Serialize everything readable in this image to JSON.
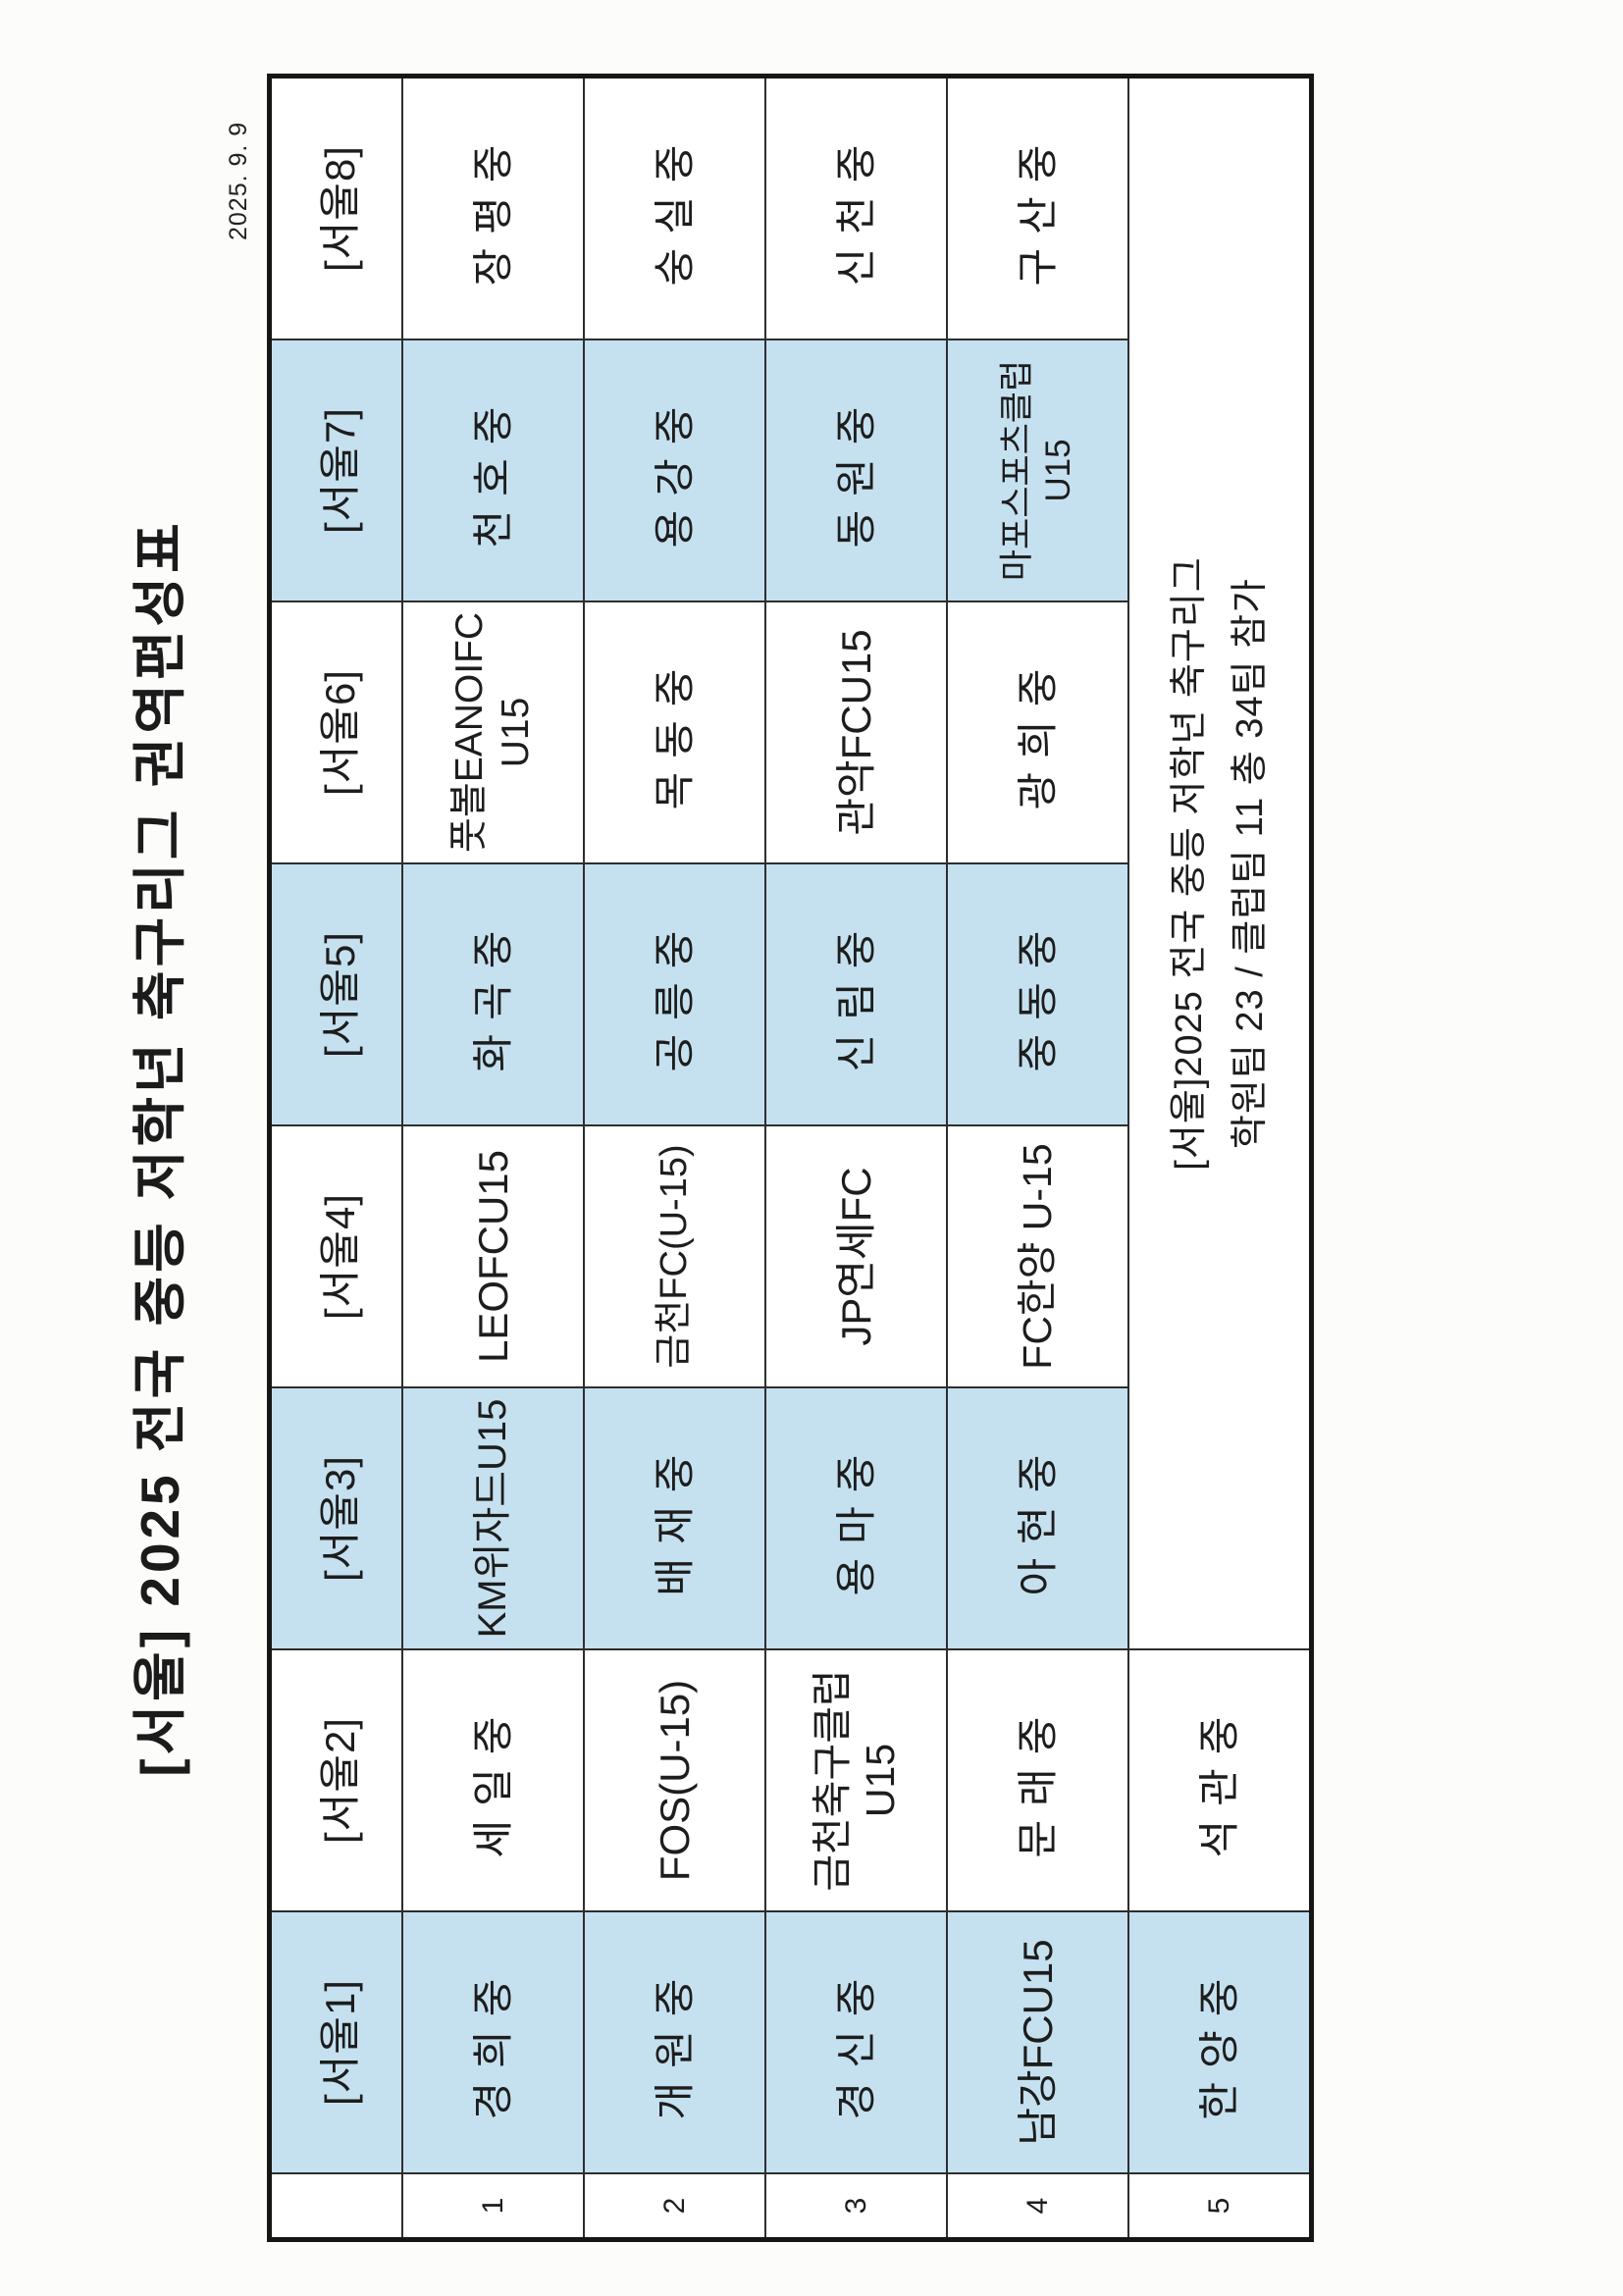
{
  "page": {
    "title": "[서울] 2025 전국 중등 저학년 축구리그 권역편성표",
    "date": "2025. 9. 9"
  },
  "table": {
    "row_numbers": [
      "1",
      "2",
      "3",
      "4",
      "5"
    ],
    "groups": [
      {
        "label": "[서울1]",
        "shaded": true,
        "teams": [
          [
            "경희중"
          ],
          [
            "개원중"
          ],
          [
            "경신중"
          ],
          [
            "남강FCU15"
          ],
          [
            "한양중"
          ]
        ]
      },
      {
        "label": "[서울2]",
        "shaded": false,
        "teams": [
          [
            "세일중"
          ],
          [
            "FOS(U-15)"
          ],
          [
            "금천축구클럽",
            "U15"
          ],
          [
            "문래중"
          ],
          [
            "석관중"
          ]
        ]
      },
      {
        "label": "[서울3]",
        "shaded": true,
        "teams": [
          [
            "KM위자드U15"
          ],
          [
            "배재중"
          ],
          [
            "용마중"
          ],
          [
            "아현중"
          ]
        ]
      },
      {
        "label": "[서울4]",
        "shaded": false,
        "teams": [
          [
            "LEOFCU15"
          ],
          [
            "금천FC(U-15)"
          ],
          [
            "JP연세FC"
          ],
          [
            "FC한양 U-15"
          ]
        ]
      },
      {
        "label": "[서울5]",
        "shaded": true,
        "teams": [
          [
            "화곡중"
          ],
          [
            "공릉중"
          ],
          [
            "신림중"
          ],
          [
            "중동중"
          ]
        ]
      },
      {
        "label": "[서울6]",
        "shaded": false,
        "teams": [
          [
            "풋볼EANOIFC",
            "U15"
          ],
          [
            "목동중"
          ],
          [
            "관악FCU15"
          ],
          [
            "광희중"
          ]
        ]
      },
      {
        "label": "[서울7]",
        "shaded": true,
        "teams": [
          [
            "천호중"
          ],
          [
            "용강중"
          ],
          [
            "동원중"
          ],
          [
            "마포스포츠클럽",
            "U15"
          ]
        ]
      },
      {
        "label": "[서울8]",
        "shaded": false,
        "teams": [
          [
            "장평중"
          ],
          [
            "숭실중"
          ],
          [
            "신천중"
          ],
          [
            "구산중"
          ]
        ]
      }
    ],
    "note_lines": [
      "[서울]2025 전국 중등 저학년 축구리그",
      "학원팀 23 / 클럽팀 11 총 34팀 참가"
    ],
    "colors": {
      "shade": "#C5E1F0",
      "grid_line": "#2e2e2e",
      "border": "#161616"
    }
  }
}
